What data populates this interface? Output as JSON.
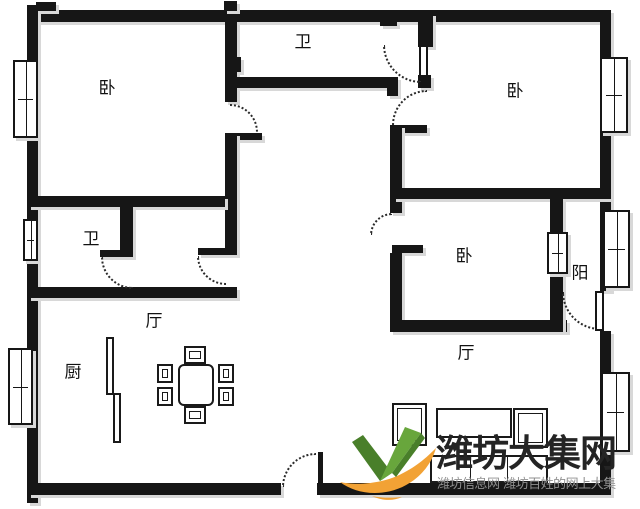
{
  "canvas": {
    "width": 640,
    "height": 509
  },
  "colors": {
    "wall": "#161616",
    "shadow": "#d8d8d8",
    "arc": "#2b2b2b",
    "title": "#242424",
    "tagline": "#8f8f8f",
    "logo_green": "#68a63c",
    "logo_green_dark": "#497f2a",
    "logo_orange": "#f2a235"
  },
  "watermark": {
    "title": "潍坊大集网",
    "tagline": "潍坊信息网 潍坊百姓的网上大集",
    "logo": "green-check-orange-swoosh-logo"
  },
  "rooms": [
    {
      "name": "bedroom-top-left",
      "label": "卧",
      "cx": 107,
      "cy": 89
    },
    {
      "name": "bath-top",
      "label": "卫",
      "cx": 303,
      "cy": 43
    },
    {
      "name": "bedroom-top-right",
      "label": "卧",
      "cx": 515,
      "cy": 92
    },
    {
      "name": "bath-left",
      "label": "卫",
      "cx": 91,
      "cy": 240
    },
    {
      "name": "dining-hall",
      "label": "厅",
      "cx": 154,
      "cy": 322
    },
    {
      "name": "kitchen",
      "label": "厨",
      "cx": 73,
      "cy": 373
    },
    {
      "name": "bedroom-middle",
      "label": "卧",
      "cx": 464,
      "cy": 257
    },
    {
      "name": "balcony",
      "label": "阳",
      "cx": 580,
      "cy": 274
    },
    {
      "name": "living-hall",
      "label": "厅",
      "cx": 466,
      "cy": 354
    }
  ],
  "walls": [
    [
      28,
      10,
      583,
      12
    ],
    [
      27,
      5,
      11,
      498
    ],
    [
      600,
      10,
      11,
      281
    ],
    [
      600,
      331,
      11,
      164
    ],
    [
      28,
      483,
      253,
      12
    ],
    [
      317,
      483,
      294,
      12
    ],
    [
      225,
      22,
      12,
      80
    ],
    [
      225,
      133,
      37,
      7
    ],
    [
      225,
      133,
      12,
      122
    ],
    [
      198,
      248,
      39,
      7
    ],
    [
      28,
      196,
      197,
      11
    ],
    [
      120,
      207,
      13,
      44
    ],
    [
      100,
      250,
      33,
      7
    ],
    [
      28,
      287,
      209,
      11
    ],
    [
      237,
      77,
      161,
      11
    ],
    [
      387,
      88,
      11,
      8
    ],
    [
      390,
      125,
      37,
      8
    ],
    [
      390,
      125,
      12,
      88
    ],
    [
      392,
      245,
      31,
      8
    ],
    [
      390,
      253,
      12,
      79
    ],
    [
      390,
      320,
      177,
      12
    ],
    [
      393,
      188,
      218,
      11
    ],
    [
      418,
      13,
      15,
      34
    ],
    [
      418,
      75,
      13,
      13
    ],
    [
      550,
      199,
      13,
      133
    ],
    [
      36,
      2,
      20,
      9
    ],
    [
      224,
      1,
      13,
      10
    ],
    [
      380,
      20,
      17,
      6
    ],
    [
      235,
      57,
      6,
      15
    ]
  ],
  "windows": [
    [
      13,
      60,
      25,
      78
    ],
    [
      23,
      219,
      15,
      42
    ],
    [
      8,
      348,
      25,
      77
    ],
    [
      600,
      57,
      28,
      76
    ],
    [
      603,
      210,
      27,
      78
    ],
    [
      601,
      372,
      29,
      80
    ],
    [
      547,
      232,
      21,
      42
    ]
  ],
  "door_arcs": [
    {
      "x": 230,
      "y": 104,
      "s": 28,
      "t": "ne"
    },
    {
      "x": 197,
      "y": 256,
      "s": 29,
      "t": "sw"
    },
    {
      "x": 101,
      "y": 257,
      "s": 32,
      "t": "sw"
    },
    {
      "x": 392,
      "y": 90,
      "s": 35,
      "t": "nw"
    },
    {
      "x": 370,
      "y": 213,
      "s": 22,
      "t": "nw"
    },
    {
      "x": 383,
      "y": 45,
      "s": 38,
      "t": "sw"
    },
    {
      "x": 562,
      "y": 292,
      "s": 38,
      "t": "sw"
    },
    {
      "x": 282,
      "y": 453,
      "s": 34,
      "t": "nw"
    }
  ],
  "door_leaves": [
    {
      "x": 419,
      "y": 45,
      "w": 9,
      "h": 32,
      "solid": false
    },
    {
      "x": 595,
      "y": 291,
      "w": 9,
      "h": 40,
      "solid": false
    },
    {
      "x": 318,
      "y": 452,
      "w": 5,
      "h": 31,
      "solid": true
    }
  ],
  "furniture": [
    {
      "name": "kitchen-partition-a",
      "x": 106,
      "y": 337,
      "w": 8,
      "h": 58,
      "style": "plain"
    },
    {
      "name": "kitchen-partition-b",
      "x": 113,
      "y": 393,
      "w": 8,
      "h": 50,
      "style": "plain"
    },
    {
      "name": "dining-table",
      "x": 178,
      "y": 364,
      "w": 36,
      "h": 42,
      "style": "table"
    },
    {
      "name": "dining-chair",
      "x": 184,
      "y": 346,
      "w": 22,
      "h": 18,
      "style": "inset"
    },
    {
      "name": "dining-chair",
      "x": 184,
      "y": 406,
      "w": 22,
      "h": 18,
      "style": "inset"
    },
    {
      "name": "dining-chair",
      "x": 157,
      "y": 364,
      "w": 16,
      "h": 19,
      "style": "inset"
    },
    {
      "name": "dining-chair",
      "x": 157,
      "y": 387,
      "w": 16,
      "h": 19,
      "style": "inset"
    },
    {
      "name": "dining-chair",
      "x": 218,
      "y": 364,
      "w": 16,
      "h": 19,
      "style": "inset"
    },
    {
      "name": "dining-chair",
      "x": 218,
      "y": 387,
      "w": 16,
      "h": 19,
      "style": "inset"
    },
    {
      "name": "armchair",
      "x": 392,
      "y": 403,
      "w": 35,
      "h": 43,
      "style": "inset"
    },
    {
      "name": "coffee-table",
      "x": 436,
      "y": 408,
      "w": 76,
      "h": 30,
      "style": "plain"
    },
    {
      "name": "armchair",
      "x": 513,
      "y": 408,
      "w": 35,
      "h": 40,
      "style": "inset"
    },
    {
      "name": "sofa",
      "x": 430,
      "y": 455,
      "w": 118,
      "h": 28,
      "style": "sofa3"
    }
  ]
}
